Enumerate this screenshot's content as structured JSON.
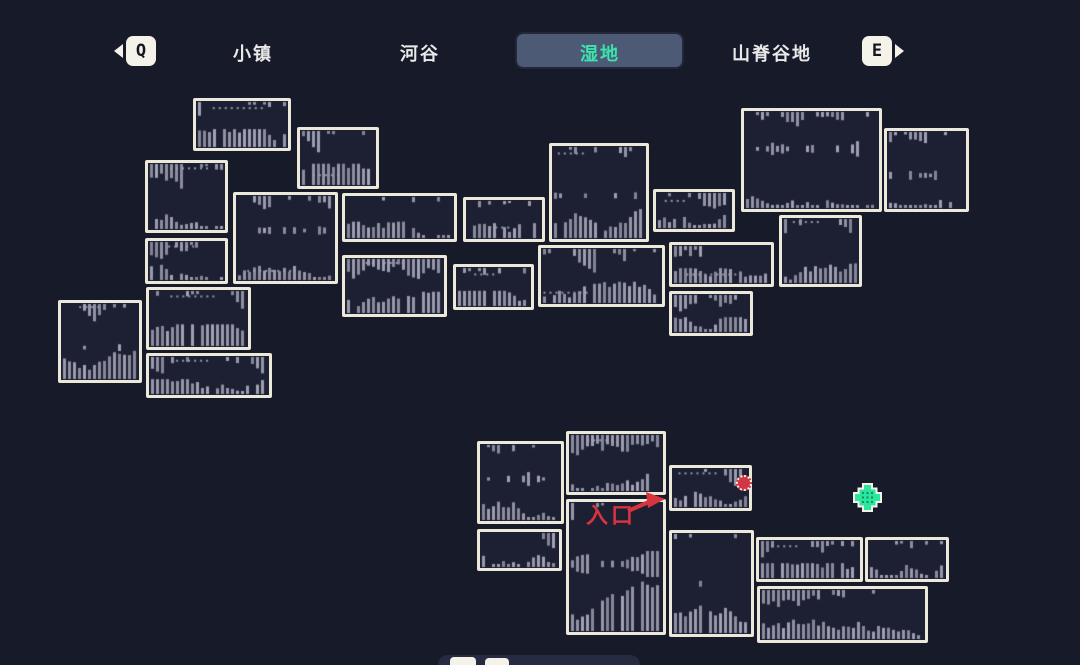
{
  "header": {
    "prev_key": "Q",
    "next_key": "E",
    "tabs": [
      {
        "label": "小镇",
        "selected": false
      },
      {
        "label": "河谷",
        "selected": false
      },
      {
        "label": "湿地",
        "selected": true
      },
      {
        "label": "山脊谷地",
        "selected": false
      }
    ],
    "selected_tab_bg": "#4d5a76",
    "selected_tab_color": "#3be3ad",
    "tab_color": "#e9e9ea"
  },
  "map": {
    "colors": {
      "background": "#171a29",
      "room_fill": "#1d2033",
      "room_border": "#ece8da",
      "texture": "#a4a4b6"
    },
    "rooms": [
      {
        "x": 193,
        "y": 98,
        "w": 98,
        "h": 53
      },
      {
        "x": 297,
        "y": 127,
        "w": 82,
        "h": 62
      },
      {
        "x": 145,
        "y": 160,
        "w": 83,
        "h": 73
      },
      {
        "x": 741,
        "y": 108,
        "w": 141,
        "h": 104
      },
      {
        "x": 884,
        "y": 128,
        "w": 85,
        "h": 84
      },
      {
        "x": 549,
        "y": 143,
        "w": 100,
        "h": 99
      },
      {
        "x": 233,
        "y": 192,
        "w": 105,
        "h": 92
      },
      {
        "x": 342,
        "y": 193,
        "w": 115,
        "h": 49
      },
      {
        "x": 463,
        "y": 197,
        "w": 82,
        "h": 45
      },
      {
        "x": 653,
        "y": 189,
        "w": 82,
        "h": 43
      },
      {
        "x": 779,
        "y": 215,
        "w": 83,
        "h": 72
      },
      {
        "x": 145,
        "y": 238,
        "w": 83,
        "h": 46
      },
      {
        "x": 669,
        "y": 242,
        "w": 105,
        "h": 45
      },
      {
        "x": 538,
        "y": 245,
        "w": 127,
        "h": 62
      },
      {
        "x": 342,
        "y": 255,
        "w": 105,
        "h": 62
      },
      {
        "x": 453,
        "y": 264,
        "w": 81,
        "h": 46
      },
      {
        "x": 146,
        "y": 287,
        "w": 105,
        "h": 63
      },
      {
        "x": 58,
        "y": 300,
        "w": 84,
        "h": 83
      },
      {
        "x": 669,
        "y": 291,
        "w": 84,
        "h": 45
      },
      {
        "x": 146,
        "y": 353,
        "w": 126,
        "h": 45
      },
      {
        "x": 477,
        "y": 441,
        "w": 87,
        "h": 83
      },
      {
        "x": 566,
        "y": 431,
        "w": 100,
        "h": 64
      },
      {
        "x": 669,
        "y": 465,
        "w": 83,
        "h": 46
      },
      {
        "x": 566,
        "y": 499,
        "w": 100,
        "h": 136
      },
      {
        "x": 477,
        "y": 529,
        "w": 85,
        "h": 42
      },
      {
        "x": 669,
        "y": 530,
        "w": 85,
        "h": 107
      },
      {
        "x": 756,
        "y": 537,
        "w": 107,
        "h": 45
      },
      {
        "x": 865,
        "y": 537,
        "w": 84,
        "h": 45
      },
      {
        "x": 757,
        "y": 586,
        "w": 171,
        "h": 57
      }
    ]
  },
  "markers": {
    "entrance_label": "入口",
    "entrance_color": "#d8333f",
    "player": {
      "x": 744,
      "y": 483,
      "color": "#cf3744"
    },
    "objective": {
      "x": 867,
      "y": 497,
      "color": "#2ce69e"
    }
  }
}
